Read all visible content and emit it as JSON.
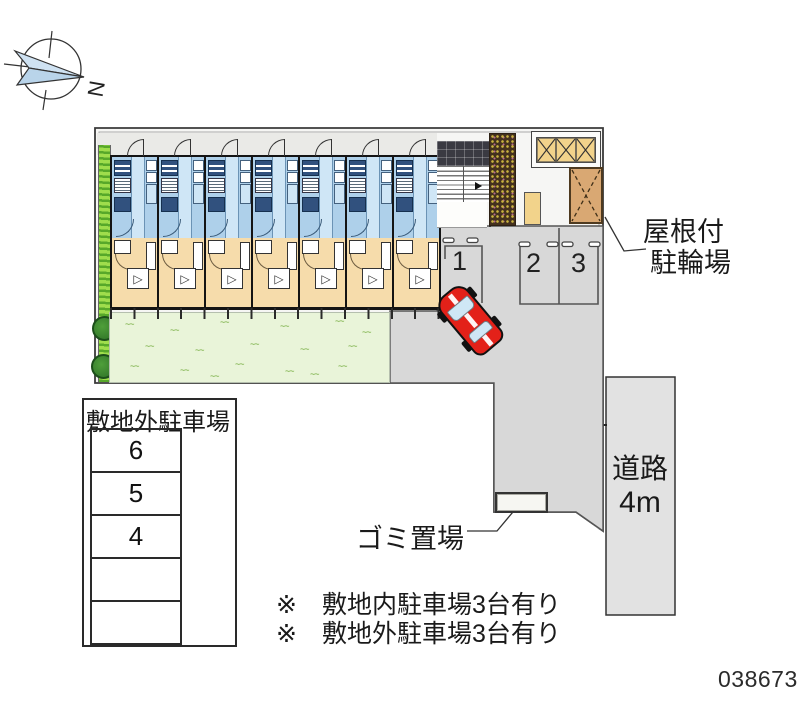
{
  "compass": {
    "north_label": "N"
  },
  "site": {
    "building_units": 7,
    "parking_space_labels": [
      "1",
      "2",
      "3"
    ],
    "bike_shed_label": [
      "屋根付",
      "駐輪場"
    ],
    "garbage_label": "ゴミ置場",
    "road_label": [
      "道路",
      "4m"
    ]
  },
  "offsite_parking_table": {
    "title": "敷地外駐車場",
    "cells": [
      "6",
      "5",
      "4",
      "",
      ""
    ]
  },
  "notes": [
    "※　敷地内駐車場3台有り",
    "※　敷地外駐車場3台有り"
  ],
  "plan_number": "038673",
  "colors": {
    "unit_wet_area": "#aed0ea",
    "unit_room": "#f6dcab",
    "lawn": "#e9f4d9",
    "hedge": "#8ed04a",
    "parking_lot": "#d8d8d8",
    "road": "#e2e2e2",
    "car": "#e32119",
    "bike_shed": "#d9a873",
    "bike_rack": "#f2d38b"
  }
}
